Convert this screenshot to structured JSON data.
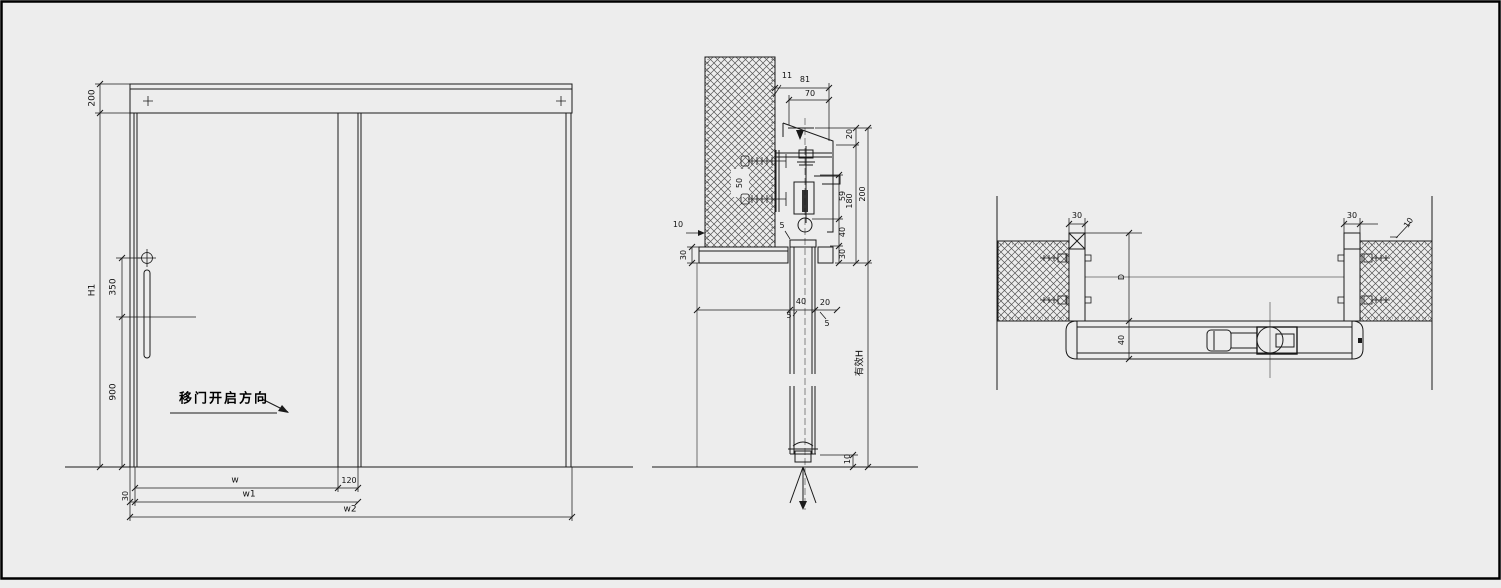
{
  "drawing": {
    "title": "sliding-door-shop-drawing",
    "background_color": "#ededed",
    "line_color": "#1a1a1a"
  },
  "elevation": {
    "open_direction_label": "移门开启方向",
    "dims": {
      "header_height": "200",
      "door_height": "H1",
      "handle_offset": "350",
      "handle_floor_height": "900",
      "clear_width": "w",
      "overlap": "120",
      "leaf_width": "w1",
      "stile_width": "30",
      "overall_width": "w2"
    }
  },
  "vertical_section": {
    "effective_height_label": "有效H",
    "dims": {
      "offset_11": "11",
      "cover_total_81": "81",
      "cover_width_70": "70",
      "wall_anchor_50": "50",
      "wall_gap_10": "10",
      "lintel_30": "30",
      "top_20": "20",
      "hanger_59": "59",
      "inner_180": "180",
      "total_200": "200",
      "clear_40": "40",
      "trim_30": "30",
      "gap_5": "5",
      "door_thickness_40": "40",
      "cover_gap_20": "20",
      "gap_5a": "5",
      "gap_5b": "5",
      "floor_gap_10": "10"
    }
  },
  "horizontal_section": {
    "dims": {
      "left_jamb_30": "30",
      "right_jamb_30": "30",
      "wall_gap_10": "10",
      "opening_D": "D",
      "door_thickness_40": "40"
    }
  }
}
